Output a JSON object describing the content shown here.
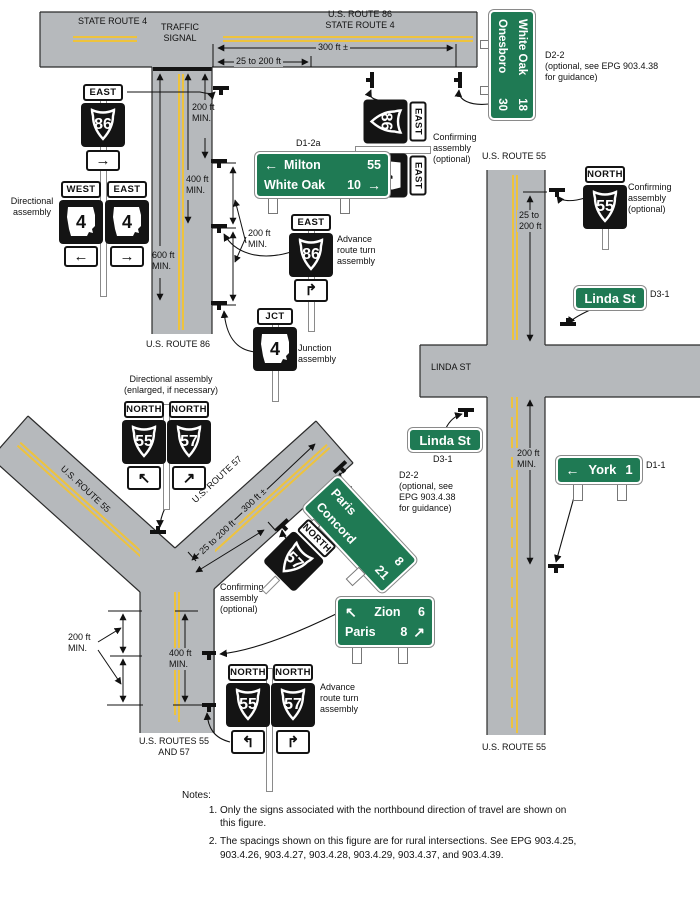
{
  "colors": {
    "road_gray": "#b6b9bc",
    "centerline_yellow": "#eec33d",
    "sign_green": "#1f7a54",
    "sign_black": "#141414"
  },
  "road_labels": {
    "state_route_4": "STATE ROUTE 4",
    "traffic_signal": "TRAFFIC\nSIGNAL",
    "us86_sr4": "U.S. ROUTE 86\nSTATE ROUTE 4",
    "us_route_86": "U.S. ROUTE 86",
    "us_route_55": "U.S. ROUTE 55",
    "linda_st": "LINDA ST",
    "us_route_57": "U.S. ROUTE 57",
    "us_routes_55_and_57": "U.S. ROUTES 55\nAND 57"
  },
  "dimensions": {
    "ft300": "300 ft ±",
    "ft25_200": "25 to 200 ft",
    "ft200_min": "200 ft\nMIN.",
    "ft400_min": "400 ft\nMIN.",
    "ft600_min": "600 ft\nMIN.",
    "ft25_200_2l": "25 to\n200 ft"
  },
  "labels": {
    "directional_assembly": "Directional\nassembly",
    "confirming_assembly": "Confirming\nassembly\n(optional)",
    "advance_assembly": "Advance\nroute turn\nassembly",
    "junction_assembly": "Junction\nassembly",
    "directional_enlarged": "Directional assembly\n(enlarged, if necessary)",
    "d1_2a": "D1-2a",
    "d2_2": "D2-2",
    "d2_2_note": "(optional, see EPG 903.4.38\nfor guidance)",
    "d2_2_note_narrow": "(optional, see\nEPG 903.4.38\nfor guidance)",
    "d3_1": "D3-1",
    "d1_1": "D1-1"
  },
  "plaques": {
    "east": "EAST",
    "west": "WEST",
    "north": "NORTH",
    "jct": "JCT"
  },
  "shields": {
    "us86": "86",
    "us55": "55",
    "us57": "57",
    "mo4": "4"
  },
  "icons": {
    "arrow_left": "←",
    "arrow_right": "→",
    "arrow_up_left": "↖",
    "arrow_up_right": "↗",
    "turn_right": "↱",
    "curve_left": "↰",
    "curve_right": "↱"
  },
  "guide_signs": {
    "milton": {
      "row1_arrow": "←",
      "row1_name": "Milton",
      "row1_dist": "55",
      "row2_name": "White Oak",
      "row2_dist": "10",
      "row2_arrow": "→"
    },
    "white_oak": {
      "row1_name": "White Oak",
      "row1_dist": "18",
      "row2_name": "Onesboro",
      "row2_dist": "30"
    },
    "paris_concord": {
      "row1_name": "Paris",
      "row1_dist": "8",
      "row2_name": "Concord",
      "row2_dist": "21"
    },
    "zion_paris": {
      "row1_arrow": "↖",
      "row1_name": "Zion",
      "row1_dist": "6",
      "row2_name": "Paris",
      "row2_dist": "8",
      "row2_arrow": "↗"
    },
    "linda": "Linda St",
    "york": {
      "arrow": "←",
      "name": "York",
      "dist": "1"
    }
  },
  "notes": {
    "title": "Notes:",
    "item1": "Only the signs associated with the northbound direction of travel are shown on this figure.",
    "item2": "The spacings shown on this figure are for rural intersections. See EPG 903.4.25, 903.4.26, 903.4.27, 903.4.28, 903.4.29, 903.4.37, and 903.4.39."
  }
}
